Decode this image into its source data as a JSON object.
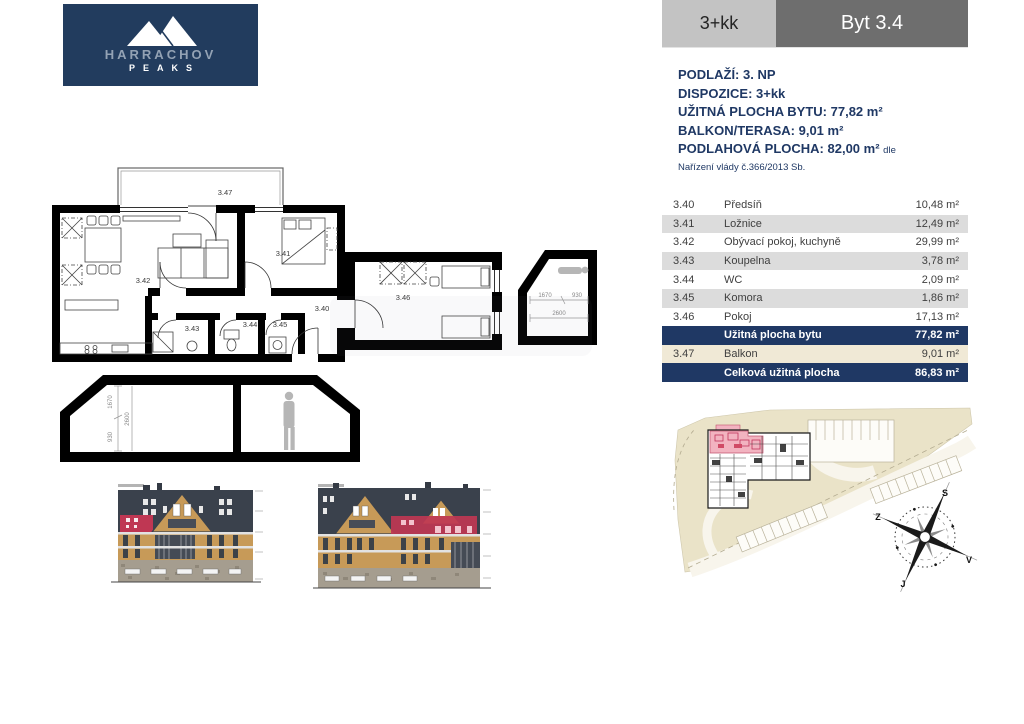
{
  "logo": {
    "name": "HARRACHOV",
    "tagline": "PEAKS"
  },
  "header": {
    "disposition": "3+kk",
    "unit": "Byt 3.4"
  },
  "info": {
    "floor": "PODLAŽÍ: 3. NP",
    "layout": "DISPOZICE: 3+kk",
    "usable_area": "UŽITNÁ PLOCHA BYTU: 77,82 m²",
    "balcony": "BALKON/TERASA: 9,01 m²",
    "floor_area": "PODLAHOVÁ PLOCHA: 82,00 m²",
    "floor_area_suffix": "dle",
    "regulation": "Nařízení vlády č.366/2013 Sb."
  },
  "rooms": {
    "rows": [
      {
        "num": "3.40",
        "name": "Předsíň",
        "area": "10,48 m²"
      },
      {
        "num": "3.41",
        "name": "Ložnice",
        "area": "12,49 m²"
      },
      {
        "num": "3.42",
        "name": "Obývací pokoj, kuchyně",
        "area": "29,99 m²"
      },
      {
        "num": "3.43",
        "name": "Koupelna",
        "area": "3,78 m²"
      },
      {
        "num": "3.44",
        "name": "WC",
        "area": "2,09 m²"
      },
      {
        "num": "3.45",
        "name": "Komora",
        "area": "1,86 m²"
      },
      {
        "num": "3.46",
        "name": "Pokoj",
        "area": "17,13 m²"
      },
      {
        "num": "",
        "name": "Užitná plocha bytu",
        "area": "77,82 m²"
      },
      {
        "num": "3.47",
        "name": "Balkon",
        "area": "9,01 m²"
      },
      {
        "num": "",
        "name": "Celková užitná plocha",
        "area": "86,83 m²"
      }
    ]
  },
  "plan": {
    "labels": {
      "hall": "3.40",
      "bedroom": "3.41",
      "living": "3.42",
      "bath": "3.43",
      "wc": "3.44",
      "storage": "3.45",
      "room": "3.46",
      "balcony": "3.47"
    },
    "dims": {
      "slope": "1670",
      "wall": "930",
      "height": "2600"
    }
  },
  "compass": {
    "north": "S",
    "west": "Z",
    "east": "V",
    "south": "J"
  },
  "colors": {
    "navy": "#1f3864",
    "logo_navy": "#223c5e",
    "accent_red": "#bf3753",
    "highlight_pink": "#f2b3c0",
    "beige": "#eae3c8",
    "wood": "#c79a58",
    "roof": "#3a414c",
    "stone": "#a59d8f",
    "header_gray": "#c3c3c3",
    "header_dark": "#6e6e6e",
    "row_gray": "#dcdcdc",
    "row_cream": "#f0e9d6"
  }
}
